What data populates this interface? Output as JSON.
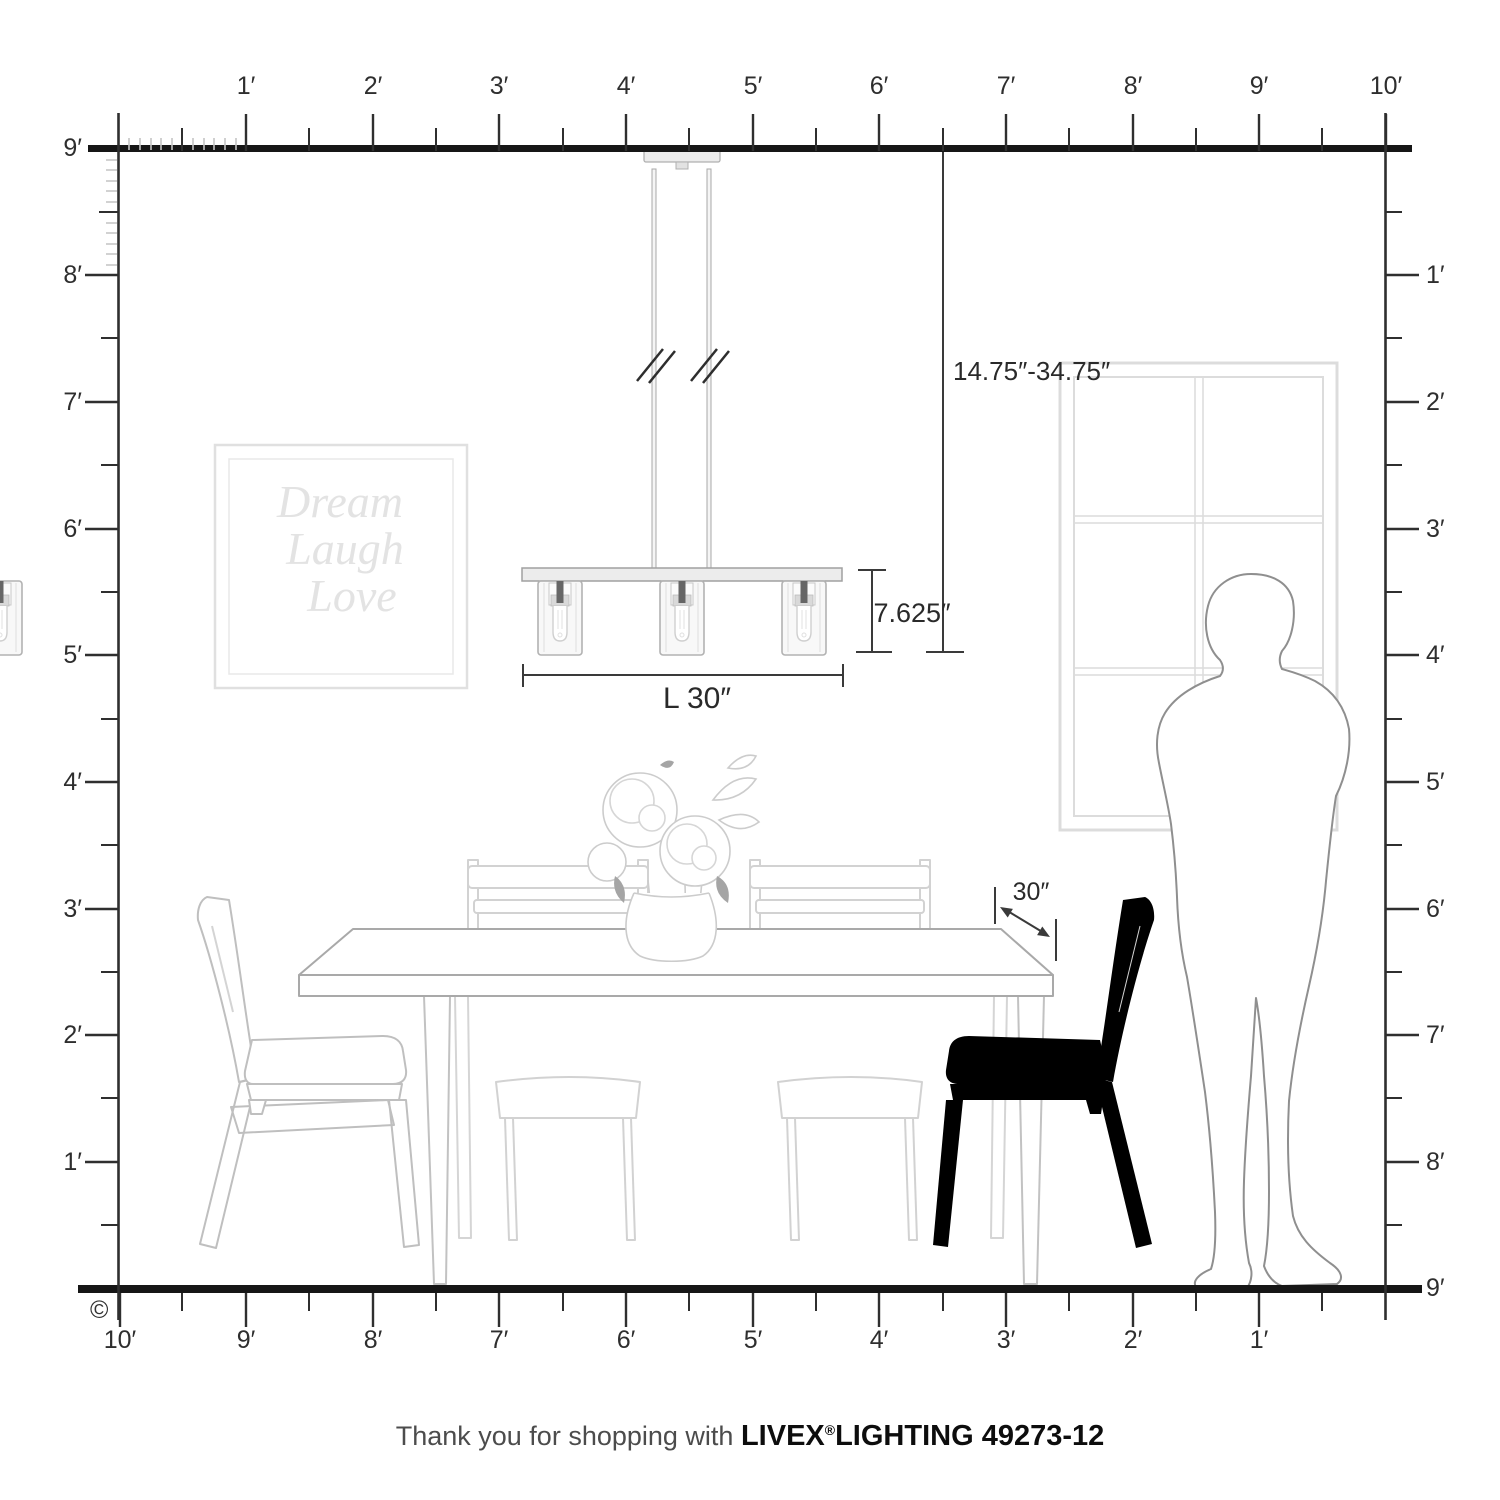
{
  "rulers": {
    "top": {
      "labels": [
        "1′",
        "2′",
        "3′",
        "4′",
        "5′",
        "6′",
        "7′",
        "8′",
        "9′",
        "10′"
      ]
    },
    "left": {
      "labels": [
        "9′",
        "8′",
        "7′",
        "6′",
        "5′",
        "4′",
        "3′",
        "2′",
        "1′"
      ]
    },
    "right": {
      "labels": [
        "1′",
        "2′",
        "3′",
        "4′",
        "5′",
        "6′",
        "7′",
        "8′",
        "9′"
      ]
    },
    "bottom": {
      "labels": [
        "10′",
        "9′",
        "8′",
        "7′",
        "6′",
        "5′",
        "4′",
        "3′",
        "2′",
        "1′"
      ]
    }
  },
  "dimensions": {
    "hang_range": "14.75″-34.75″",
    "fixture_height": "7.625″",
    "fixture_length": "L 30″",
    "table_clearance": "30″"
  },
  "wall_art": {
    "lines": [
      "Dream",
      "Laugh",
      "Love"
    ]
  },
  "footer": {
    "prefix": "Thank you for shopping with",
    "brand": "LIVEX",
    "registered": "®",
    "product": "LIGHTING 49273-12"
  },
  "copyright_symbol": "©",
  "colors": {
    "ruler_line": "#2f2f2f",
    "structure_line": "#161616",
    "dimension_line": "#3a3a3a",
    "furniture_gray": "#c4c4c4",
    "art_gray": "#e3e3e3",
    "person_gray": "#8f8f8f"
  }
}
